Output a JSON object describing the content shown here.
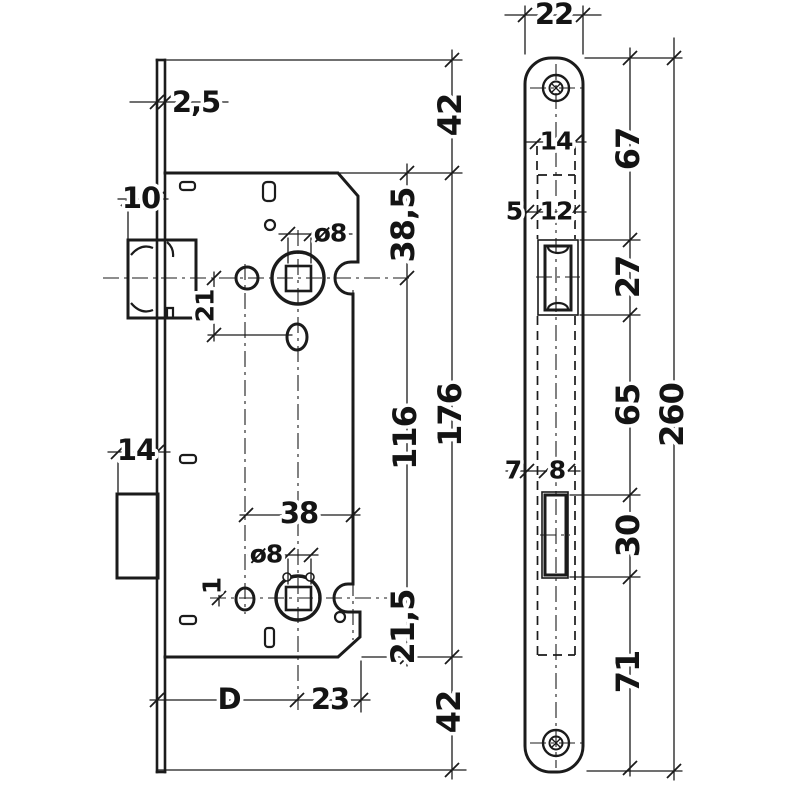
{
  "drawing": {
    "kind": "mortise-lock technical drawing, two views with dimension chains",
    "colors": {
      "ink": "#1b1b1b",
      "paper": "#ffffff"
    },
    "labels": {
      "faceplate_thickness": "2,5",
      "latch_protrusion": "10",
      "bolt_protrusion": "14",
      "follower_offset": "21",
      "nut_offset": "1",
      "spindle_upper": "ø8",
      "spindle_lower": "ø8",
      "hole_spacing": "38",
      "backset": "D",
      "axis_to_back": "23",
      "plate_top_to_case": "42",
      "case_top_to_axis": "38,5",
      "axis_spacing": "116",
      "case_length": "176",
      "axis_to_case_bottom": "21,5",
      "case_to_plate_bottom": "42",
      "plate_width": "22",
      "case_width": "14",
      "edge_to_case": "5",
      "latch_cutout_width": "12",
      "top_to_latch_cutout": "67",
      "latch_cutout_height": "27",
      "edge_to_bolt_cutout": "7",
      "bolt_cutout_width": "8",
      "latch_to_bolt_cutout": "65",
      "bolt_cutout_height": "30",
      "bolt_cutout_to_bottom": "71",
      "plate_length": "260"
    }
  }
}
